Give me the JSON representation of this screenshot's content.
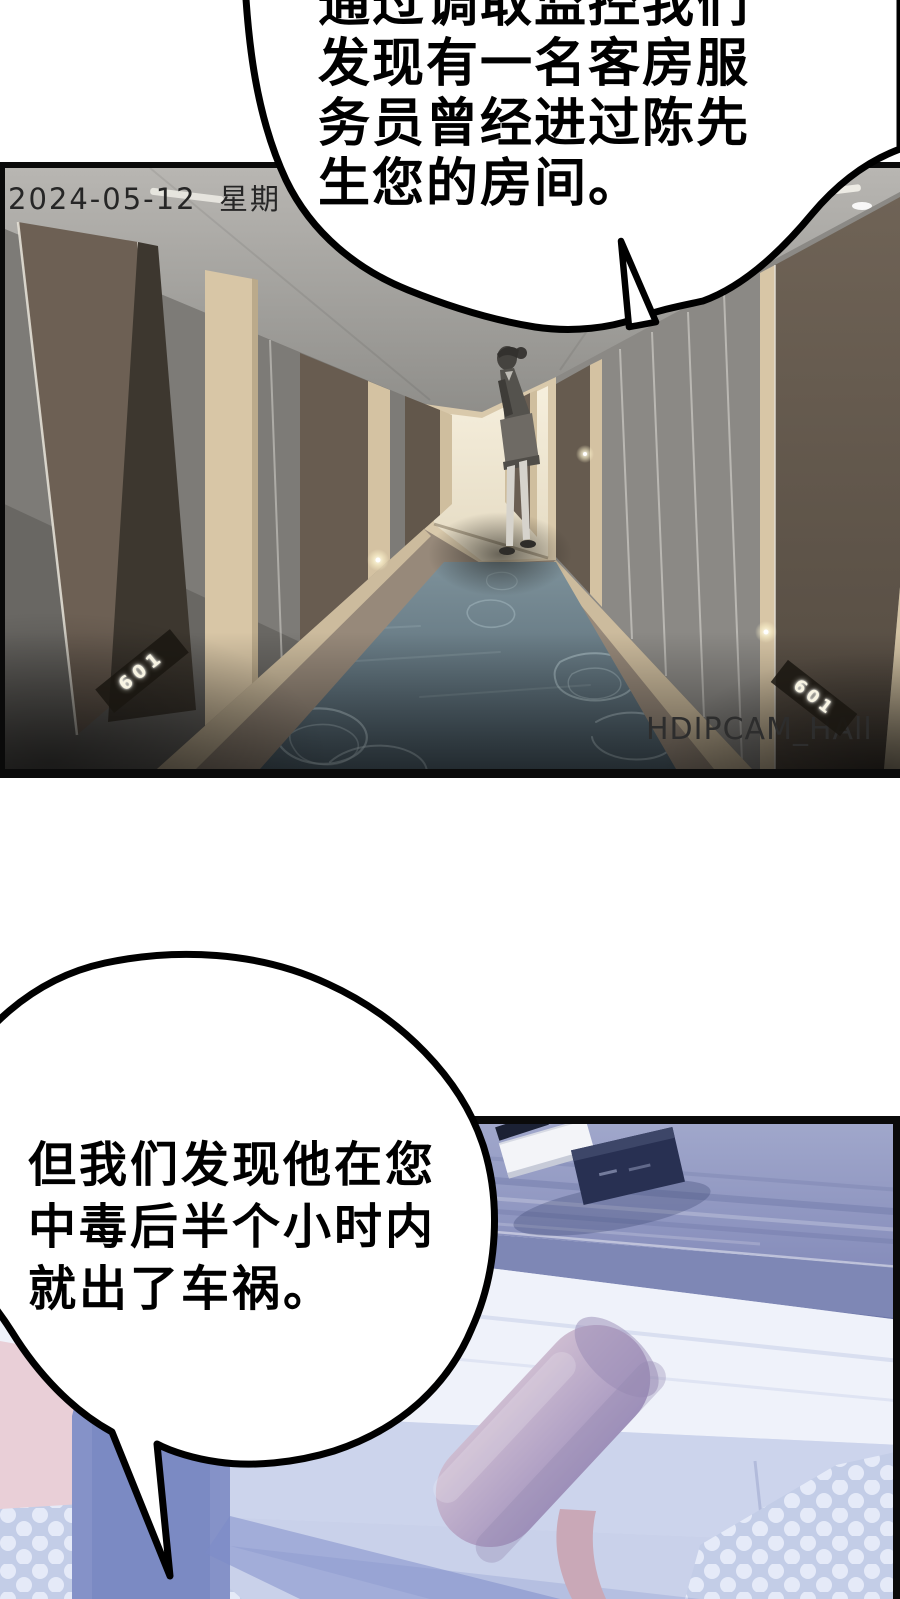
{
  "speech_bubbles": {
    "top": {
      "lines": [
        "通过调取监控我们",
        "发现有一名客房服",
        "务员曾经进过陈先",
        "生您的房间。"
      ],
      "fill": "#ffffff",
      "stroke": "#000000"
    },
    "bottom": {
      "lines": [
        "但我们发现他在您",
        "中毒后半个小时内",
        "就出了车祸。"
      ],
      "fill": "#ffffff",
      "stroke": "#000000"
    }
  },
  "cctv_panel": {
    "timestamp": "2024-05-12  星期",
    "watermark": "HDIPCAM_HAll",
    "door_plates": {
      "left": "601",
      "right": "601"
    },
    "colors": {
      "ceiling": "#aba9a5",
      "wall_gray": "#8f8d89",
      "door_brown": "#6b6054",
      "door_frame": "#d8c7a6",
      "carpet": "#5d707b",
      "end_wall": "#f1e9d7",
      "border": "#0a0a0a"
    }
  },
  "room_panel": {
    "colors": {
      "tint": "#e2e6f3",
      "wood": "#959cc3",
      "pillow": "#b9aac6",
      "rug": "#c3cde7",
      "rug_dot": "#e7ecf8",
      "shadow_blue": "#8592c8",
      "pink": "#e9cfd7",
      "navy_book": "#283052",
      "border": "#0a0a0a"
    }
  }
}
